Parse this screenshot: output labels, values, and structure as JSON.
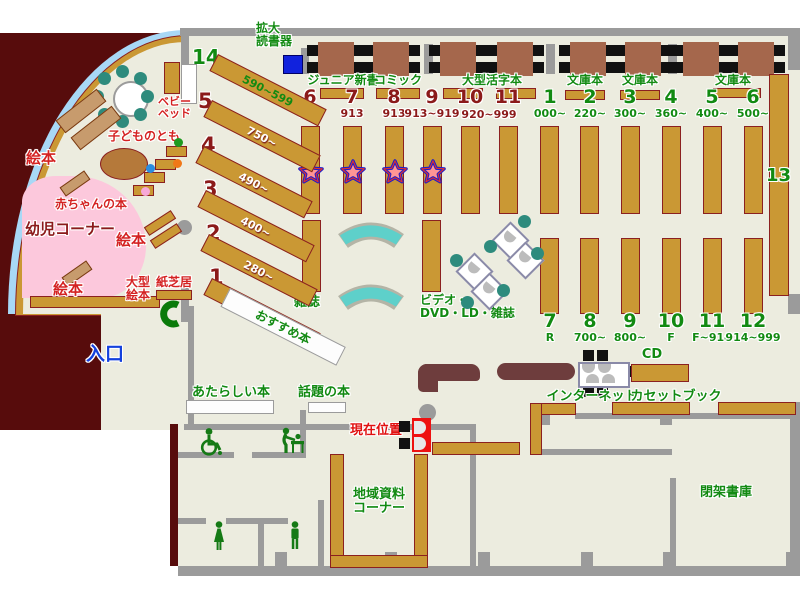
{
  "colors": {
    "floor": "#ececdf",
    "wall": "#9b9b9b",
    "closed_area": "#570c0c",
    "shelf": "#ca9834",
    "shelf_border": "#8b2020",
    "table": "#a5674c",
    "counter": "#6e3d3d",
    "green_text": "#128a12",
    "dark_red_text": "#8b1a1a",
    "red_text": "#d42222",
    "blue_text": "#1441dd",
    "pink_area": "#fcc8dc",
    "light_blue_rim": "#a8d8f6",
    "teal": "#2e8b7d",
    "kiosk_red": "#ee1111",
    "magnifier_blue": "#1122dd"
  },
  "labels": {
    "magnifier_l1": "拡大",
    "magnifier_l2": "読書器",
    "junior": "ジュニア新書",
    "comic": "コミック",
    "large_print": "大型活字本",
    "bunko_a": "文庫本",
    "bunko_b": "文庫本",
    "bunko_c": "文庫本",
    "baby_bed_l1": "ベビー",
    "baby_bed_l2": "ベッド",
    "kodomo": "子どものとも",
    "baby_books": "赤ちゃんの本",
    "infant": "幼児コーナー",
    "ehon_a": "絵本",
    "ehon_b": "絵本",
    "ehon_c": "絵本",
    "large_ehon_l1": "大型",
    "large_ehon_l2": "絵本",
    "kamishibai": "紙芝居",
    "recommend": "おすすめ本",
    "entrance": "入口",
    "magazine": "雑誌",
    "av_l1": "ビデオ・",
    "av_l2": "DVD・LD・雑誌",
    "internet": "インターネット",
    "cd": "CD",
    "cassette": "カセットブック",
    "new_books": "あたらしい本",
    "topic": "話題の本",
    "current": "現在位置",
    "local_l1": "地域資料",
    "local_l2": "コーナー",
    "closed": "閉架書庫",
    "shelf13": "13"
  },
  "diagonal_shelves": [
    {
      "no": "14",
      "range": "590~599"
    },
    {
      "no": "5",
      "range": "750~"
    },
    {
      "no": "4",
      "range": "490~"
    },
    {
      "no": "3",
      "range": "400~"
    },
    {
      "no": "2",
      "range": "280~"
    },
    {
      "no": "1",
      "range": "000~"
    }
  ],
  "red_row": {
    "items": [
      {
        "no": "6",
        "range": "913"
      },
      {
        "no": "7",
        "range": "913"
      },
      {
        "no": "8",
        "range": "913"
      },
      {
        "no": "9",
        "range": "913~919"
      },
      {
        "no": "10",
        "range": ""
      },
      {
        "no": "11",
        "range": ""
      }
    ],
    "shared_range": "920~999"
  },
  "green_top": [
    {
      "no": "1",
      "range": "000~"
    },
    {
      "no": "2",
      "range": "220~"
    },
    {
      "no": "3",
      "range": "300~"
    },
    {
      "no": "4",
      "range": "360~"
    },
    {
      "no": "5",
      "range": "400~"
    },
    {
      "no": "6",
      "range": "500~"
    }
  ],
  "green_bottom": [
    {
      "no": "7",
      "range": "R"
    },
    {
      "no": "8",
      "range": "700~"
    },
    {
      "no": "9",
      "range": "800~"
    },
    {
      "no": "10",
      "range": "F"
    },
    {
      "no": "11",
      "range": "F~914"
    },
    {
      "no": "12",
      "range": "914~999"
    }
  ]
}
